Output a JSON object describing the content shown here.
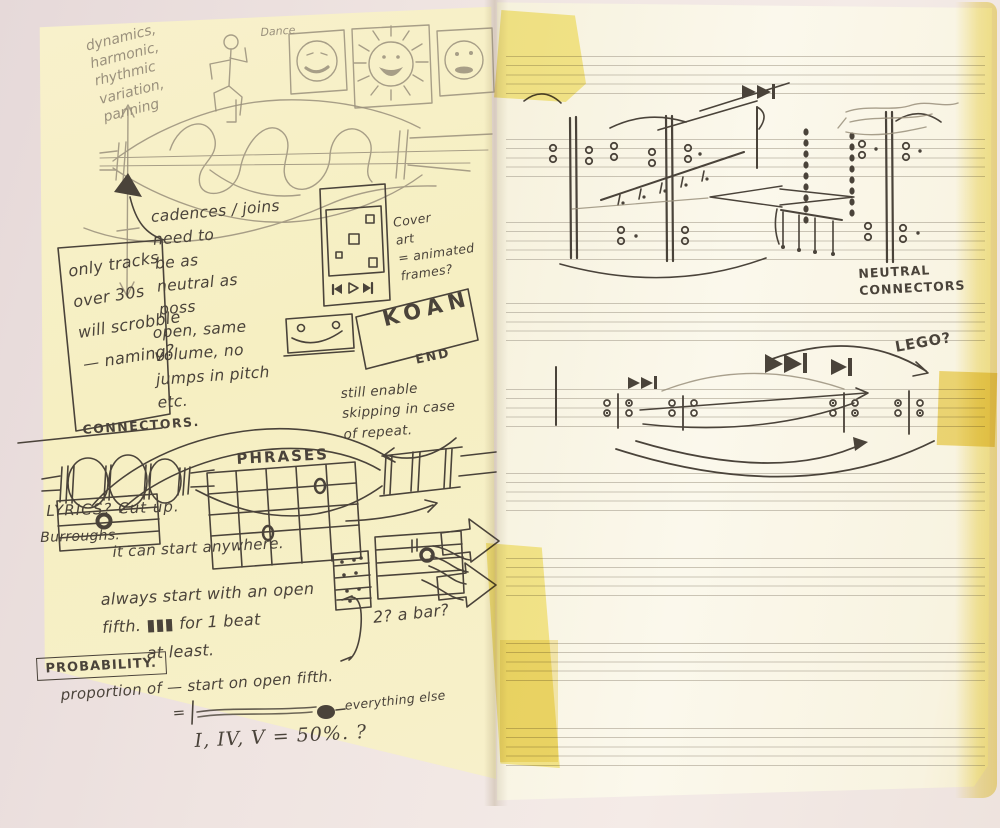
{
  "colors": {
    "desk": "#ece0de",
    "left_page": "#f7f0c9",
    "right_page": "#faf6e7",
    "tape": "#f4e46e",
    "ink": "#4a433a",
    "pencil": "#9a907c",
    "staff_line": "#b9b2a2",
    "page_edge": "#f3e695"
  },
  "left_page": {
    "pencil": {
      "dimensions": "dynamics,\nharmonic,\nrhythmic\nvariation,\npanning",
      "dance": "Dance"
    },
    "notes": {
      "scrobble": "only tracks\nover 30s\nwill scrobble\n— naming?",
      "cadences": "cadences / joins\nneed to\nbe as\nneutral as\nposs",
      "cover_art": "Cover\nart\n= animated\nframes?",
      "koan": "KOAN",
      "end": "END",
      "open_same": "open, same\nvolume, no\njumps in pitch\netc.",
      "connectors": "CONNECTORS.",
      "still_enable": "still enable\nskipping in case\nof repeat.",
      "phrases": "PHRASES",
      "lyrics": "LYRICS? Cut up.",
      "burroughs": "Burroughs.",
      "start_anywhere": "it can start anywhere.",
      "open_fifth": "always start with an open\nfifth. ▮▮▮ for 1 beat\n        at least.",
      "bar_question": "2? a bar?",
      "probability": "PROBABILITY.",
      "proportion": "proportion of — start on open fifth.",
      "equals": "=",
      "everything_else": "everything else",
      "chords_pct": "I, IV, V = 50%. ?"
    }
  },
  "right_page": {
    "labels": {
      "neutral_connectors": "NEUTRAL\nCONNECTORS",
      "lego": "LEGO?"
    },
    "icons": {
      "skip_forward": "▶▶|"
    }
  }
}
